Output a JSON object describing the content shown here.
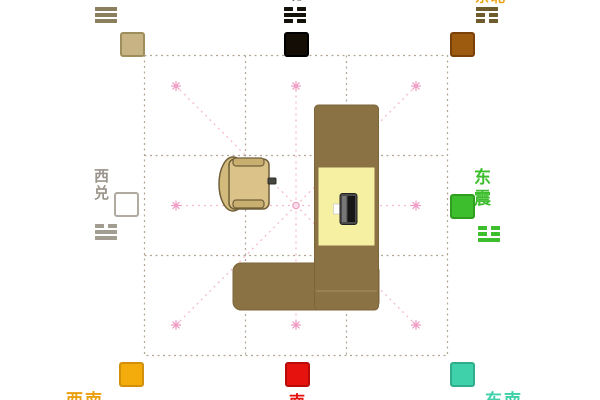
{
  "diagram": {
    "type": "feng-shui-room-direction-diagram",
    "background_color": "#ffffff",
    "grid": {
      "rows": 3,
      "cols": 3,
      "line_color": "#b3a794",
      "line_style": "dashed"
    },
    "rays": {
      "count": 8,
      "line_color": "#f5bccd",
      "star_color": "#ef9cc4",
      "center_marker": "pink-circle"
    }
  },
  "compass_markers": [
    {
      "direction_en": "northwest",
      "label": "西北",
      "label_clipped": "top-edge",
      "label_color": "#8b7f5e",
      "trigram_name": "qian",
      "trigram_lines": [
        1,
        1,
        1
      ],
      "trigram_color": "#8b7f5e",
      "square_color": "#c7b383",
      "square_border": "#9e8e5e"
    },
    {
      "direction_en": "north",
      "label": "北",
      "label_clipped": "top-edge",
      "label_color": "#14100a",
      "trigram_name": "kan",
      "trigram_lines": [
        0,
        1,
        0
      ],
      "trigram_color": "#14100a",
      "square_color": "#140d05",
      "square_border": "#000000"
    },
    {
      "direction_en": "northeast",
      "label": "东北",
      "label_clipped": "top-edge",
      "label_color": "#eda318",
      "trigram_name": "gen",
      "trigram_lines": [
        1,
        0,
        0
      ],
      "trigram_color": "#6e5c2c",
      "square_color": "#9c5b0f",
      "square_border": "#7c4108"
    },
    {
      "direction_en": "west",
      "label": "西兑",
      "label_clipped": "none",
      "label_color": "#9a948a",
      "trigram_name": "dui",
      "trigram_lines": [
        0,
        1,
        1
      ],
      "trigram_color": "#a39d91",
      "square_color": "#fefefe",
      "square_border": "#b0aaa0"
    },
    {
      "direction_en": "east",
      "label": "东震",
      "label_clipped": "none",
      "label_color": "#3cbe2d",
      "trigram_name": "zhen",
      "trigram_lines": [
        0,
        0,
        1
      ],
      "trigram_color": "#3cbe2d",
      "square_color": "#3cbe2d",
      "square_border": "#2f9e20"
    },
    {
      "direction_en": "southwest",
      "label": "西南",
      "label_clipped": "bottom-edge",
      "label_color": "#eaa00e",
      "square_color": "#f4ab0c",
      "square_border": "#d3900a"
    },
    {
      "direction_en": "south",
      "label": "南",
      "label_clipped": "bottom-edge",
      "label_color": "#e5120e",
      "square_color": "#e5120e",
      "square_border": "#b90c0a"
    },
    {
      "direction_en": "southeast",
      "label": "东南",
      "label_clipped": "bottom-edge",
      "label_color": "#3fd1a9",
      "square_color": "#3fd1a9",
      "square_border": "#2fae8b"
    }
  ],
  "room": {
    "furniture": [
      {
        "name": "l-shaped-desk",
        "color": "#8a7245",
        "pad_color": "#f6f0a2"
      },
      {
        "name": "office-chair",
        "color": "#dbc289",
        "outline_color": "#6f5e38"
      },
      {
        "name": "computer",
        "body_color": "#4a4a4a"
      }
    ]
  }
}
